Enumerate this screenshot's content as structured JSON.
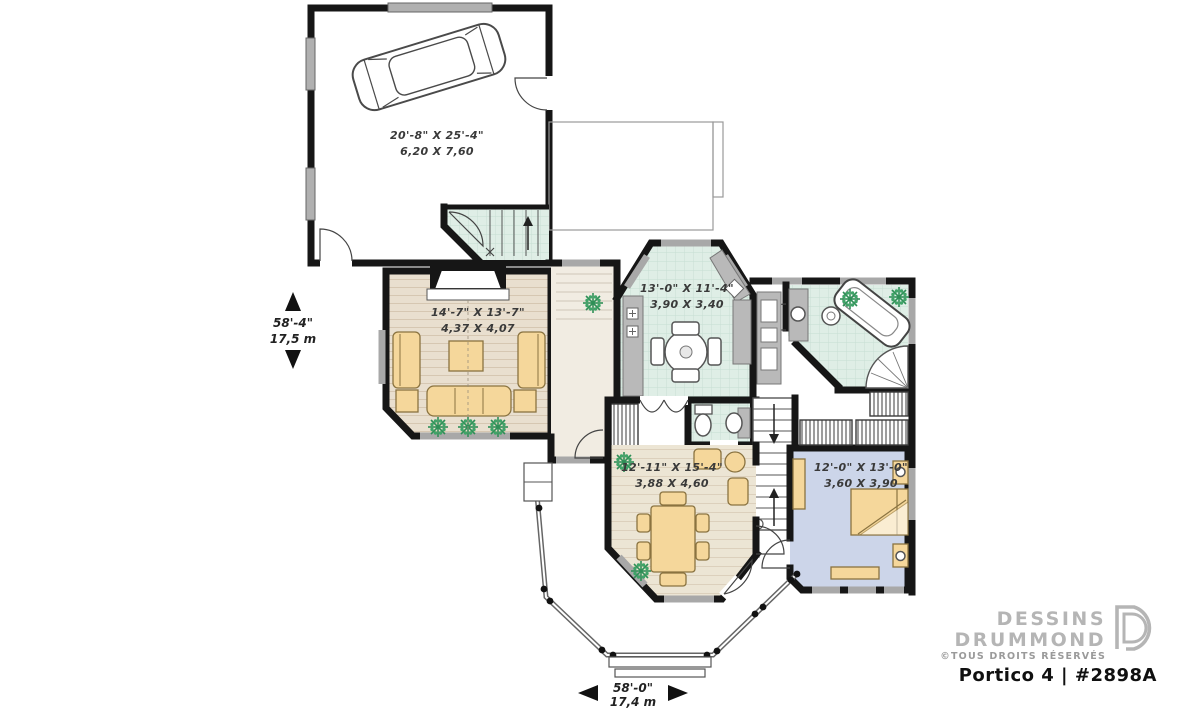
{
  "document": {
    "type": "architectural floor plan, main level"
  },
  "rooms": {
    "garage": {
      "imperial": "20'-8\" X 25'-4\"",
      "metric": "6,20 X 7,60"
    },
    "living_room": {
      "imperial": "14'-7\" X 13'-7\"",
      "metric": "4,37 X 4,07"
    },
    "kitchen": {
      "imperial": "13'-0\" X 11'-4\"",
      "metric": "3,90 X 3,40"
    },
    "dining_room": {
      "imperial": "12'-11\" X 15'-4\"",
      "metric": "3,88 X 4,60"
    },
    "bedroom": {
      "imperial": "12'-0\" X 13'-0\"",
      "metric": "3,60 X 3,90"
    }
  },
  "dimensions": {
    "overall_depth": {
      "imperial": "58'-4\"",
      "metric": "17,5 m"
    },
    "overall_width": {
      "imperial": "58'-0\"",
      "metric": "17,4 m"
    }
  },
  "branding": {
    "company_line1": "DESSINS",
    "company_line2": "DRUMMOND",
    "rights": "©TOUS DROITS RÉSERVÉS",
    "plan_title": "Portico 4 | #2898A"
  },
  "colors": {
    "wall": "#161616",
    "tile_floor": "#dfeee6",
    "tile_grid": "#c6ded2",
    "wood_floor": "#e9dfcf",
    "dining_floor": "#ece5d4",
    "bedroom_floor": "#ccd5e9",
    "furniture": "#f5d79b",
    "counter": "#b9b9b9",
    "window": "#a8a8a8",
    "plant_green": "#2f8f57",
    "logo_gray": "#b5b5b5"
  }
}
